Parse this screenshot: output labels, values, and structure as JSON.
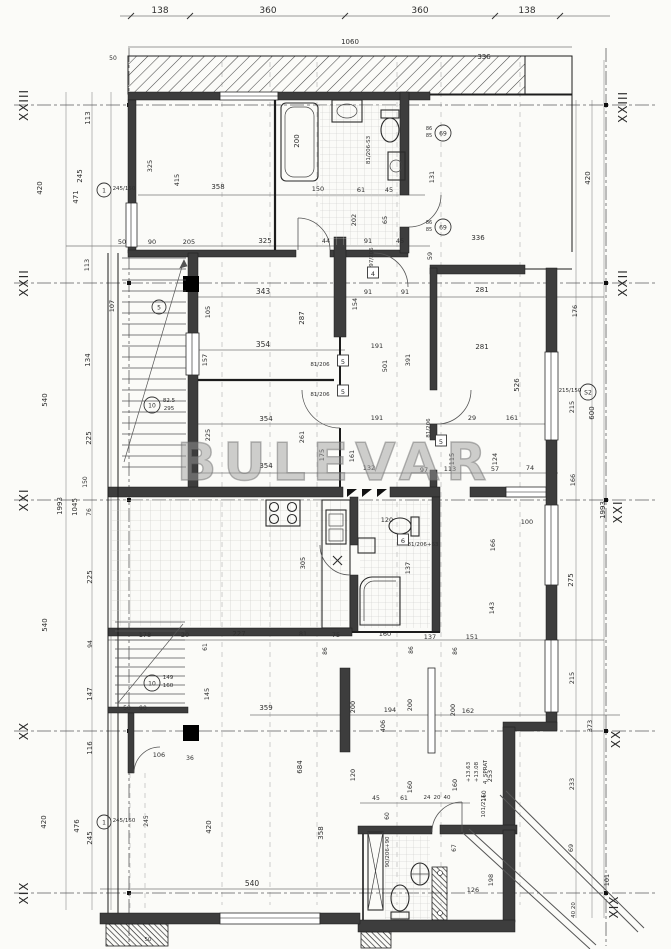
{
  "meta": {
    "title": "Apartment floor plan – 4th floor",
    "watermark": "BULEVAR",
    "floor_note": "4. SPRAT",
    "elevations": [
      "+13.63",
      "+13.08"
    ],
    "paper_color": "#fbfbf8",
    "line_color": "#2e2e2e",
    "watermark_color": "#9a9a9a"
  },
  "axes": {
    "left": [
      "XXIII",
      "XXII",
      "XXI",
      "XX",
      "XIX"
    ],
    "right": [
      "XXIII",
      "XXII",
      "XXI",
      "XX",
      "XIX"
    ]
  },
  "dimension_chains": {
    "top": [
      "138",
      "360",
      "360",
      "138"
    ],
    "top_total": "1060",
    "left": [
      "420",
      "540",
      "540",
      "420"
    ],
    "left_total": "1993",
    "bottom": "540"
  },
  "labels": [
    {
      "t": "XXIII",
      "x": 28,
      "y": 105,
      "r": -90,
      "s": 12,
      "c": "axis"
    },
    {
      "t": "XXII",
      "x": 28,
      "y": 283,
      "r": -90,
      "s": 12,
      "c": "axis"
    },
    {
      "t": "XXI",
      "x": 28,
      "y": 500,
      "r": -90,
      "s": 12,
      "c": "axis"
    },
    {
      "t": "XX",
      "x": 28,
      "y": 731,
      "r": -90,
      "s": 12,
      "c": "axis"
    },
    {
      "t": "XIX",
      "x": 28,
      "y": 893,
      "r": -90,
      "s": 12,
      "c": "axis"
    },
    {
      "t": "XXIII",
      "x": 627,
      "y": 107,
      "r": -90,
      "s": 12,
      "c": "axis"
    },
    {
      "t": "XXII",
      "x": 627,
      "y": 283,
      "r": -90,
      "s": 12,
      "c": "axis"
    },
    {
      "t": "XXI",
      "x": 622,
      "y": 512,
      "r": -90,
      "s": 12,
      "c": "axis"
    },
    {
      "t": "XX",
      "x": 620,
      "y": 739,
      "r": -90,
      "s": 12,
      "c": "axis"
    },
    {
      "t": "XIX",
      "x": 618,
      "y": 907,
      "r": -90,
      "s": 12,
      "c": "axis"
    },
    {
      "t": "138",
      "x": 160,
      "y": 13,
      "s": 9
    },
    {
      "t": "360",
      "x": 268,
      "y": 13,
      "s": 9
    },
    {
      "t": "360",
      "x": 420,
      "y": 13,
      "s": 9
    },
    {
      "t": "138",
      "x": 527,
      "y": 13,
      "s": 9
    },
    {
      "t": "1060",
      "x": 350,
      "y": 44,
      "s": 7
    },
    {
      "t": "50",
      "x": 113,
      "y": 60,
      "s": 6
    },
    {
      "t": "336",
      "x": 484,
      "y": 59,
      "s": 7
    },
    {
      "t": "336",
      "x": 478,
      "y": 240,
      "s": 7
    },
    {
      "t": "420",
      "x": 42,
      "y": 188,
      "r": -90
    },
    {
      "t": "471",
      "x": 78,
      "y": 197,
      "r": -90
    },
    {
      "t": "245",
      "x": 82,
      "y": 176,
      "r": -90
    },
    {
      "t": "113",
      "x": 90,
      "y": 118,
      "r": -90
    },
    {
      "t": "540",
      "x": 47,
      "y": 400,
      "r": -90
    },
    {
      "t": "1993",
      "x": 62,
      "y": 506,
      "r": -90
    },
    {
      "t": "1045",
      "x": 77,
      "y": 507,
      "r": -90
    },
    {
      "t": "225",
      "x": 91,
      "y": 438,
      "r": -90
    },
    {
      "t": "150",
      "x": 87,
      "y": 482,
      "r": -90,
      "s": 6
    },
    {
      "t": "76",
      "x": 91,
      "y": 512,
      "r": -90,
      "s": 6
    },
    {
      "t": "225",
      "x": 92,
      "y": 577,
      "r": -90
    },
    {
      "t": "540",
      "x": 47,
      "y": 625,
      "r": -90
    },
    {
      "t": "94",
      "x": 92,
      "y": 644,
      "r": -90,
      "s": 6
    },
    {
      "t": "147",
      "x": 92,
      "y": 694,
      "r": -90
    },
    {
      "t": "116",
      "x": 92,
      "y": 748,
      "r": -90
    },
    {
      "t": "476",
      "x": 79,
      "y": 826,
      "r": -90
    },
    {
      "t": "245",
      "x": 92,
      "y": 838,
      "r": -90
    },
    {
      "t": "420",
      "x": 46,
      "y": 822,
      "r": -90
    },
    {
      "t": "420",
      "x": 211,
      "y": 827,
      "r": -90
    },
    {
      "t": "245",
      "x": 148,
      "y": 821,
      "r": -90,
      "s": 6
    },
    {
      "t": "245/150",
      "x": 124,
      "y": 190,
      "s": 5.5
    },
    {
      "t": "245/150",
      "x": 124,
      "y": 822,
      "s": 5.5
    },
    {
      "t": "358",
      "x": 218,
      "y": 189
    },
    {
      "t": "415",
      "x": 179,
      "y": 180,
      "r": -90,
      "s": 6.5
    },
    {
      "t": "325",
      "x": 152,
      "y": 166,
      "r": -90,
      "s": 6.5
    },
    {
      "t": "150",
      "x": 318,
      "y": 191,
      "s": 6.5
    },
    {
      "t": "61",
      "x": 361,
      "y": 192,
      "s": 6.5
    },
    {
      "t": "45",
      "x": 389,
      "y": 192,
      "s": 6.5
    },
    {
      "t": "200",
      "x": 299,
      "y": 141,
      "r": -90
    },
    {
      "t": "202",
      "x": 356,
      "y": 220,
      "r": -90,
      "s": 6.5
    },
    {
      "t": "65",
      "x": 387,
      "y": 220,
      "r": -90,
      "s": 6.5
    },
    {
      "t": "131",
      "x": 434,
      "y": 177,
      "r": -90,
      "s": 6.5
    },
    {
      "t": "81/206-S3",
      "x": 370,
      "y": 150,
      "r": -90,
      "s": 5.5
    },
    {
      "t": "86",
      "x": 429,
      "y": 130,
      "s": 5
    },
    {
      "t": "85",
      "x": 429,
      "y": 137,
      "s": 5
    },
    {
      "t": "86",
      "x": 429,
      "y": 224,
      "s": 5
    },
    {
      "t": "85",
      "x": 429,
      "y": 231,
      "s": 5
    },
    {
      "t": "50",
      "x": 122,
      "y": 244,
      "s": 6.5
    },
    {
      "t": "90",
      "x": 152,
      "y": 244,
      "s": 6.5
    },
    {
      "t": "205",
      "x": 189,
      "y": 244,
      "s": 6.5
    },
    {
      "t": "325",
      "x": 265,
      "y": 243
    },
    {
      "t": "44",
      "x": 326,
      "y": 243,
      "s": 6.5
    },
    {
      "t": "91",
      "x": 368,
      "y": 243,
      "s": 6.5
    },
    {
      "t": "45",
      "x": 400,
      "y": 243,
      "s": 6.5
    },
    {
      "t": "59",
      "x": 432,
      "y": 256,
      "r": -90,
      "s": 6.5
    },
    {
      "t": "343",
      "x": 263,
      "y": 294,
      "s": 7.5
    },
    {
      "t": "105",
      "x": 210,
      "y": 312,
      "r": -90,
      "s": 6.5
    },
    {
      "t": "287",
      "x": 304,
      "y": 318,
      "r": -90
    },
    {
      "t": "154",
      "x": 357,
      "y": 304,
      "r": -90,
      "s": 6.5
    },
    {
      "t": "91",
      "x": 368,
      "y": 294,
      "s": 6.5
    },
    {
      "t": "91",
      "x": 405,
      "y": 294,
      "s": 6.5
    },
    {
      "t": "354",
      "x": 263,
      "y": 347,
      "s": 7.5
    },
    {
      "t": "354",
      "x": 266,
      "y": 421
    },
    {
      "t": "354",
      "x": 266,
      "y": 468
    },
    {
      "t": "157",
      "x": 207,
      "y": 360,
      "r": -90,
      "s": 6.5
    },
    {
      "t": "134",
      "x": 90,
      "y": 360,
      "r": -90
    },
    {
      "t": "107",
      "x": 114,
      "y": 306,
      "r": -90,
      "s": 6.5
    },
    {
      "t": "113",
      "x": 89,
      "y": 265,
      "r": -90,
      "s": 6.5
    },
    {
      "t": "82.5",
      "x": 169,
      "y": 402,
      "s": 5.5
    },
    {
      "t": "295",
      "x": 169,
      "y": 410,
      "s": 5.5
    },
    {
      "t": "191",
      "x": 377,
      "y": 348,
      "s": 6.5
    },
    {
      "t": "191",
      "x": 377,
      "y": 420,
      "s": 6.5
    },
    {
      "t": "391",
      "x": 410,
      "y": 360,
      "r": -90,
      "s": 6.5
    },
    {
      "t": "501",
      "x": 387,
      "y": 366,
      "r": -90,
      "s": 6.5
    },
    {
      "t": "281",
      "x": 482,
      "y": 292
    },
    {
      "t": "281",
      "x": 482,
      "y": 349
    },
    {
      "t": "526",
      "x": 519,
      "y": 385,
      "r": -90
    },
    {
      "t": "161",
      "x": 512,
      "y": 420,
      "s": 6.5
    },
    {
      "t": "29",
      "x": 472,
      "y": 420,
      "s": 6.5
    },
    {
      "t": "124",
      "x": 497,
      "y": 459,
      "r": -90,
      "s": 6.5
    },
    {
      "t": "57",
      "x": 495,
      "y": 471,
      "s": 6.5
    },
    {
      "t": "74",
      "x": 530,
      "y": 470,
      "s": 6.5
    },
    {
      "t": "115",
      "x": 454,
      "y": 459,
      "r": -90,
      "s": 6.5
    },
    {
      "t": "113",
      "x": 450,
      "y": 471,
      "s": 6.5
    },
    {
      "t": "97",
      "x": 424,
      "y": 472,
      "s": 6.5
    },
    {
      "t": "132",
      "x": 369,
      "y": 470,
      "s": 6.5
    },
    {
      "t": "161",
      "x": 354,
      "y": 456,
      "r": -90,
      "s": 6.5
    },
    {
      "t": "175",
      "x": 324,
      "y": 455,
      "r": -90,
      "s": 6.5
    },
    {
      "t": "261",
      "x": 304,
      "y": 437,
      "r": -90,
      "s": 6.5
    },
    {
      "t": "225",
      "x": 210,
      "y": 435,
      "r": -90,
      "s": 6.5
    },
    {
      "t": "81/206",
      "x": 320,
      "y": 366,
      "s": 5.5
    },
    {
      "t": "81/206",
      "x": 320,
      "y": 396,
      "s": 5.5
    },
    {
      "t": "81/206",
      "x": 430,
      "y": 428,
      "r": -90,
      "s": 5.5
    },
    {
      "t": "97/206",
      "x": 373,
      "y": 257,
      "r": -90,
      "s": 5.5
    },
    {
      "t": "81/206+63",
      "x": 423,
      "y": 546,
      "s": 5.5
    },
    {
      "t": "420",
      "x": 590,
      "y": 178,
      "r": -90
    },
    {
      "t": "176",
      "x": 577,
      "y": 311,
      "r": -90,
      "s": 6.5
    },
    {
      "t": "215/150",
      "x": 570,
      "y": 392,
      "s": 5.5
    },
    {
      "t": "215",
      "x": 574,
      "y": 407,
      "r": -90,
      "s": 6.5
    },
    {
      "t": "600",
      "x": 594,
      "y": 413,
      "r": -90
    },
    {
      "t": "166",
      "x": 575,
      "y": 480,
      "r": -90,
      "s": 6.5
    },
    {
      "t": "1993",
      "x": 605,
      "y": 510,
      "r": -90
    },
    {
      "t": "100",
      "x": 527,
      "y": 524,
      "s": 6.5
    },
    {
      "t": "166",
      "x": 495,
      "y": 545,
      "r": -90,
      "s": 6.5
    },
    {
      "t": "143",
      "x": 494,
      "y": 608,
      "r": -90,
      "s": 6.5
    },
    {
      "t": "275",
      "x": 573,
      "y": 580,
      "r": -90
    },
    {
      "t": "215",
      "x": 574,
      "y": 678,
      "r": -90,
      "s": 6.5
    },
    {
      "t": "373",
      "x": 592,
      "y": 726,
      "r": -90,
      "s": 6.5
    },
    {
      "t": "233",
      "x": 574,
      "y": 784,
      "r": -90,
      "s": 6.5
    },
    {
      "t": "69",
      "x": 573,
      "y": 848,
      "r": -90,
      "s": 6.5
    },
    {
      "t": "101",
      "x": 609,
      "y": 880,
      "r": -90,
      "s": 6.5
    },
    {
      "t": "40 20",
      "x": 575,
      "y": 910,
      "r": -90,
      "s": 5.5
    },
    {
      "t": "305",
      "x": 305,
      "y": 563,
      "r": -90,
      "s": 6.5
    },
    {
      "t": "120",
      "x": 387,
      "y": 522,
      "s": 6.5
    },
    {
      "t": "137",
      "x": 410,
      "y": 568,
      "r": -90,
      "s": 6.5
    },
    {
      "t": "178",
      "x": 145,
      "y": 637,
      "s": 6.5
    },
    {
      "t": "20",
      "x": 185,
      "y": 637,
      "s": 6.5
    },
    {
      "t": "227",
      "x": 239,
      "y": 636
    },
    {
      "t": "81",
      "x": 303,
      "y": 636,
      "s": 6.5
    },
    {
      "t": "75",
      "x": 336,
      "y": 637,
      "s": 6.5
    },
    {
      "t": "160",
      "x": 385,
      "y": 636,
      "s": 6.5
    },
    {
      "t": "137",
      "x": 430,
      "y": 639,
      "s": 6.5
    },
    {
      "t": "151",
      "x": 472,
      "y": 639,
      "s": 6.5
    },
    {
      "t": "86",
      "x": 327,
      "y": 651,
      "r": -90,
      "s": 6
    },
    {
      "t": "86",
      "x": 413,
      "y": 650,
      "r": -90,
      "s": 6
    },
    {
      "t": "86",
      "x": 457,
      "y": 651,
      "r": -90,
      "s": 6
    },
    {
      "t": "359",
      "x": 266,
      "y": 710
    },
    {
      "t": "145",
      "x": 209,
      "y": 694,
      "r": -90,
      "s": 6.5
    },
    {
      "t": "61",
      "x": 207,
      "y": 647,
      "r": -90,
      "s": 6
    },
    {
      "t": "200",
      "x": 355,
      "y": 707,
      "r": -90,
      "s": 6.5
    },
    {
      "t": "194",
      "x": 390,
      "y": 712,
      "s": 6.5
    },
    {
      "t": "200",
      "x": 412,
      "y": 705,
      "r": -90,
      "s": 6.5
    },
    {
      "t": "406",
      "x": 385,
      "y": 726,
      "r": -90,
      "s": 6.5
    },
    {
      "t": "200",
      "x": 455,
      "y": 710,
      "r": -90,
      "s": 6.5
    },
    {
      "t": "162",
      "x": 468,
      "y": 713,
      "s": 6.5
    },
    {
      "t": "684",
      "x": 302,
      "y": 767,
      "r": -90
    },
    {
      "t": "120",
      "x": 355,
      "y": 775,
      "r": -90,
      "s": 6.5
    },
    {
      "t": "358",
      "x": 323,
      "y": 833,
      "r": -90
    },
    {
      "t": "160",
      "x": 412,
      "y": 787,
      "r": -90,
      "s": 6.5
    },
    {
      "t": "160",
      "x": 457,
      "y": 785,
      "r": -90,
      "s": 6.5
    },
    {
      "t": "36",
      "x": 190,
      "y": 760,
      "s": 6
    },
    {
      "t": "106",
      "x": 159,
      "y": 757,
      "s": 6.5
    },
    {
      "t": "50",
      "x": 127,
      "y": 710,
      "s": 6
    },
    {
      "t": "90",
      "x": 143,
      "y": 710,
      "s": 6
    },
    {
      "t": "149",
      "x": 168,
      "y": 679,
      "s": 5.5
    },
    {
      "t": "160",
      "x": 168,
      "y": 687,
      "s": 5.5
    },
    {
      "t": "45",
      "x": 376,
      "y": 800,
      "s": 6
    },
    {
      "t": "61",
      "x": 404,
      "y": 800,
      "s": 6
    },
    {
      "t": "24",
      "x": 427,
      "y": 799,
      "s": 5.5
    },
    {
      "t": "20",
      "x": 437,
      "y": 799,
      "s": 5.5
    },
    {
      "t": "40",
      "x": 447,
      "y": 799,
      "s": 5.5
    },
    {
      "t": "60",
      "x": 389,
      "y": 816,
      "r": -90,
      "s": 6
    },
    {
      "t": "90/206+90",
      "x": 389,
      "y": 852,
      "r": -90,
      "s": 5.5
    },
    {
      "t": "101/211",
      "x": 485,
      "y": 806,
      "r": -90,
      "s": 5.5
    },
    {
      "t": "+13.63",
      "x": 470,
      "y": 772,
      "r": -90,
      "s": 5.5
    },
    {
      "t": "+13.08",
      "x": 478,
      "y": 772,
      "r": -90,
      "s": 5.5
    },
    {
      "t": "4. SPRAT",
      "x": 487,
      "y": 772,
      "r": -90,
      "s": 5.5
    },
    {
      "t": "253",
      "x": 492,
      "y": 776,
      "r": -90,
      "s": 6.5
    },
    {
      "t": "160",
      "x": 486,
      "y": 796,
      "r": -90,
      "s": 6
    },
    {
      "t": "67",
      "x": 456,
      "y": 848,
      "r": -90,
      "s": 6
    },
    {
      "t": "126",
      "x": 473,
      "y": 892,
      "s": 6.5
    },
    {
      "t": "198",
      "x": 493,
      "y": 880,
      "r": -90,
      "s": 6.5
    },
    {
      "t": "540",
      "x": 252,
      "y": 886,
      "s": 7.5
    },
    {
      "t": "50",
      "x": 148,
      "y": 941,
      "s": 5.5
    }
  ],
  "circled_marks": [
    {
      "t": "1",
      "x": 104,
      "y": 190
    },
    {
      "t": "1",
      "x": 104,
      "y": 822
    },
    {
      "t": "10",
      "x": 152,
      "y": 405
    },
    {
      "t": "10",
      "x": 152,
      "y": 683
    },
    {
      "t": "S2",
      "x": 588,
      "y": 392
    },
    {
      "t": "69",
      "x": 443,
      "y": 133
    },
    {
      "t": "69",
      "x": 443,
      "y": 227
    },
    {
      "t": "5",
      "x": 159,
      "y": 307
    }
  ],
  "boxed_marks": [
    {
      "t": "5",
      "x": 343,
      "y": 363
    },
    {
      "t": "5",
      "x": 343,
      "y": 393
    },
    {
      "t": "5",
      "x": 441,
      "y": 443
    },
    {
      "t": "4",
      "x": 373,
      "y": 275
    },
    {
      "t": "6",
      "x": 403,
      "y": 542
    }
  ]
}
